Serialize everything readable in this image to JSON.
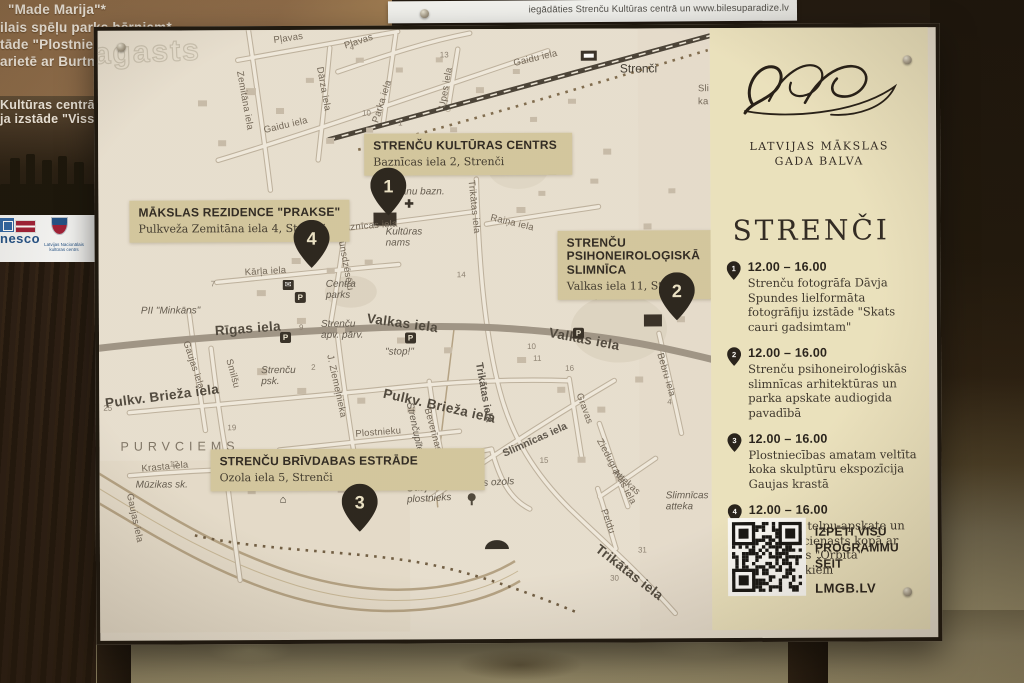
{
  "surroundings": {
    "ticket_strip_text": "iegādāties Strenču Kultūras centrā un www.bilesuparadize.lv",
    "back_sign": {
      "lines": [
        "\"Made Marija\"*",
        "ilais spēļu parks bērniem*",
        "tāde \"Plostnieku",
        "arietē ar Burtnie"
      ],
      "photo_lines": [
        "Kultūras centrā a",
        "ja izstāde \"Viss, k"
      ],
      "unesco_text": "nesco",
      "lnkc_text": "Latvijas Nacionālais kultūras centrs"
    }
  },
  "board": {
    "logo": {
      "line1": "LATVIJAS MĀKSLAS",
      "line2": "GADA BALVA"
    },
    "panel": {
      "city_title": "STRENČI",
      "schedule": [
        {
          "num": "1",
          "time": "12.00 – 16.00",
          "desc": "Strenču fotogrāfa Dāvja Spundes lielformāta fotogrāfiju izstāde \"Skats cauri gadsimtam\""
        },
        {
          "num": "2",
          "time": "12.00 – 16.00",
          "desc": "Strenču psihoneiroloģiskās slimnīcas arhitektūras un parka apskate audiogida pavadībā"
        },
        {
          "num": "3",
          "time": "12.00 – 16.00",
          "desc": "Plostniecības amatam veltīta koka skulptūru ekspozīcija Gaujas krastā"
        },
        {
          "num": "4",
          "time": "12.00 – 16.00",
          "desc": "Tikšanās, telpu apskate un pankūku cienasts kopā ar apvienības \"Orbīta\" māksliniekiem"
        }
      ],
      "qr_caption_line1": "IZPĒTI VISU",
      "qr_caption_line2": "PROGRAMMU ŠEIT",
      "site": "LMGB.LV"
    },
    "callouts": [
      {
        "num": "1",
        "title": "STRENČU KULTŪRAS CENTRS",
        "address": "Baznīcas iela 2, Strenči"
      },
      {
        "num": "2",
        "title": "STRENČU PSIHONEIROLOĢISKĀ SLIMNĪCA",
        "address": "Valkas iela 11, Strenči"
      },
      {
        "num": "3",
        "title": "STRENČU BRĪVDABAS ESTRĀDE",
        "address": "Ozola iela 5, Strenči"
      },
      {
        "num": "4",
        "title": "MĀKSLAS REZIDENCE \"PRAKSE\"",
        "address": "Pulkveža Zemitāna iela 4, Strenči"
      }
    ],
    "map": {
      "watermark": "agasts",
      "labels": [
        {
          "t": "agasts",
          "x": -4,
          "y": 8,
          "r": -2,
          "c": "wm"
        },
        {
          "t": "Zemitāna iela",
          "x": 141,
          "y": 36,
          "r": 80,
          "c": "s"
        },
        {
          "t": "Pļavas",
          "x": 176,
          "y": 6,
          "r": -8,
          "c": "s"
        },
        {
          "t": "Pļavas",
          "x": 247,
          "y": 12,
          "r": -18,
          "c": "s"
        },
        {
          "t": "Parka iela",
          "x": 278,
          "y": 88,
          "r": -72,
          "c": "s"
        },
        {
          "t": "Dārza iela",
          "x": 221,
          "y": 32,
          "r": 80,
          "c": "s"
        },
        {
          "t": "Gaidu iela",
          "x": 166,
          "y": 96,
          "r": -13,
          "c": "s"
        },
        {
          "t": "Gaidu iela",
          "x": 416,
          "y": 30,
          "r": -13,
          "c": "s"
        },
        {
          "t": "Upes iela",
          "x": 345,
          "y": 74,
          "r": -80,
          "c": "s"
        },
        {
          "t": "Strenči",
          "x": 522,
          "y": 34,
          "r": 0,
          "c": "st"
        },
        {
          "t": "Sli",
          "x": 600,
          "y": 56,
          "r": 0,
          "c": "s"
        },
        {
          "t": "ka",
          "x": 600,
          "y": 69,
          "r": 0,
          "c": "s"
        },
        {
          "t": "Raiņa iela",
          "x": 392,
          "y": 184,
          "r": 14,
          "c": "s"
        },
        {
          "t": "Baznīcas iela",
          "x": 240,
          "y": 194,
          "r": -4,
          "c": "s"
        },
        {
          "t": "Trikātas iela",
          "x": 372,
          "y": 146,
          "r": 84,
          "c": "s"
        },
        {
          "t": "rānu bazn.",
          "x": 299,
          "y": 158,
          "r": 0,
          "c": "i"
        },
        {
          "t": "✚",
          "x": 306,
          "y": 170,
          "r": 0,
          "c": "ic",
          "n": "church-icon"
        },
        {
          "t": "Kultūras\nnams",
          "x": 287,
          "y": 198,
          "r": 0,
          "c": "i"
        },
        {
          "t": "14",
          "x": 358,
          "y": 242,
          "c": "n"
        },
        {
          "t": "Ugunsdzēsēju",
          "x": 240,
          "y": 194,
          "r": 80,
          "c": "s"
        },
        {
          "t": "Kārļa iela",
          "x": 146,
          "y": 238,
          "r": -3,
          "c": "s"
        },
        {
          "t": "Centra\nparks",
          "x": 227,
          "y": 250,
          "r": 0,
          "c": "i"
        },
        {
          "t": "✉",
          "x": 184,
          "y": 250,
          "r": 0,
          "c": "icd",
          "n": "post-office-icon"
        },
        {
          "t": "P",
          "x": 196,
          "y": 262,
          "c": "p"
        },
        {
          "t": "PII \"Minkāns\"",
          "x": 42,
          "y": 276,
          "r": 0,
          "c": "i"
        },
        {
          "t": "Rīgas iela",
          "x": 116,
          "y": 294,
          "r": -4,
          "c": "b"
        },
        {
          "t": "Valkas iela",
          "x": 268,
          "y": 282,
          "r": 8,
          "c": "b"
        },
        {
          "t": "Valkas iela",
          "x": 450,
          "y": 297,
          "r": 11,
          "c": "b"
        },
        {
          "t": "Strenču\napv. pārv.",
          "x": 222,
          "y": 290,
          "r": 0,
          "c": "i"
        },
        {
          "t": "\"stop!\"",
          "x": 286,
          "y": 318,
          "r": 0,
          "c": "i"
        },
        {
          "t": "P",
          "x": 181,
          "y": 302,
          "c": "p"
        },
        {
          "t": "P",
          "x": 306,
          "y": 303,
          "c": "p"
        },
        {
          "t": "P",
          "x": 474,
          "y": 299,
          "c": "p"
        },
        {
          "t": "parks",
          "x": 497,
          "y": 262,
          "r": 0,
          "c": "i"
        },
        {
          "t": "Smilšu",
          "x": 129,
          "y": 324,
          "r": 75,
          "c": "s"
        },
        {
          "t": "Strenču\npsk.",
          "x": 162,
          "y": 336,
          "r": 0,
          "c": "i"
        },
        {
          "t": "Gaujas iela",
          "x": 86,
          "y": 306,
          "r": 72,
          "c": "s"
        },
        {
          "t": "J. Ziemeļnieka",
          "x": 230,
          "y": 320,
          "r": 78,
          "c": "s"
        },
        {
          "t": "Pulkv. Brieža iela",
          "x": 284,
          "y": 357,
          "r": 13,
          "c": "b"
        },
        {
          "t": "Pulkv. Brieža iela",
          "x": 6,
          "y": 366,
          "r": -7,
          "c": "b"
        },
        {
          "t": "Beverīnas",
          "x": 327,
          "y": 374,
          "r": 75,
          "c": "s"
        },
        {
          "t": "Strenčupīte",
          "x": 309,
          "y": 368,
          "r": 78,
          "c": "i"
        },
        {
          "t": "Plostnieku",
          "x": 256,
          "y": 400,
          "r": -4,
          "c": "s"
        },
        {
          "t": "Trikātas iela",
          "x": 379,
          "y": 328,
          "r": 80,
          "c": "m"
        },
        {
          "t": "Slimnīcas iela",
          "x": 404,
          "y": 420,
          "r": -24,
          "c": "m"
        },
        {
          "t": "Gravas",
          "x": 479,
          "y": 360,
          "r": 70,
          "c": "s"
        },
        {
          "t": "Ziedugravas iela",
          "x": 499,
          "y": 406,
          "r": 62,
          "c": "s"
        },
        {
          "t": "Attekas",
          "x": 514,
          "y": 438,
          "r": 42,
          "c": "s"
        },
        {
          "t": "Peldu",
          "x": 503,
          "y": 476,
          "r": 70,
          "c": "s"
        },
        {
          "t": "Bebru iela",
          "x": 560,
          "y": 320,
          "r": 74,
          "c": "s"
        },
        {
          "t": "Ozola",
          "x": 352,
          "y": 427,
          "r": -14,
          "c": "s"
        },
        {
          "t": "Vecais ozols",
          "x": 359,
          "y": 451,
          "r": -3,
          "c": "i"
        },
        {
          "t": "Gaujas\nplostnieks",
          "x": 307,
          "y": 455,
          "r": -3,
          "c": "i"
        },
        {
          "t": "P",
          "x": 320,
          "y": 438,
          "c": "p"
        },
        {
          "t": "⌂",
          "x": 180,
          "y": 465,
          "r": 0,
          "c": "ic",
          "n": "house-icon"
        },
        {
          "t": "Slimnīcas\natteka",
          "x": 566,
          "y": 463,
          "r": 0,
          "c": "i"
        },
        {
          "t": "Trikātas iela",
          "x": 497,
          "y": 512,
          "r": 38,
          "c": "b"
        },
        {
          "t": "PURVCIEMS",
          "x": 21,
          "y": 410,
          "r": 0,
          "c": "cap"
        },
        {
          "t": "Krasta iela",
          "x": 42,
          "y": 434,
          "r": -5,
          "c": "s"
        },
        {
          "t": "Mūzikas sk.",
          "x": 36,
          "y": 450,
          "r": 0,
          "c": "i"
        },
        {
          "t": "Gaujas iela",
          "x": 29,
          "y": 458,
          "r": 78,
          "c": "s"
        },
        {
          "t": "13",
          "x": 342,
          "y": 22,
          "c": "n"
        },
        {
          "t": "4",
          "x": 252,
          "y": 14,
          "c": "n"
        },
        {
          "t": "10",
          "x": 264,
          "y": 80,
          "c": "n"
        },
        {
          "t": "1",
          "x": 300,
          "y": 90,
          "c": "n"
        },
        {
          "t": "7",
          "x": 112,
          "y": 250,
          "c": "n"
        },
        {
          "t": "9",
          "x": 200,
          "y": 294,
          "c": "n"
        },
        {
          "t": "2",
          "x": 212,
          "y": 334,
          "c": "n"
        },
        {
          "t": "10",
          "x": 428,
          "y": 314,
          "c": "n"
        },
        {
          "t": "11",
          "x": 434,
          "y": 326,
          "c": "n"
        },
        {
          "t": "16",
          "x": 466,
          "y": 336,
          "c": "n"
        },
        {
          "t": "15",
          "x": 440,
          "y": 428,
          "c": "n"
        },
        {
          "t": "30",
          "x": 510,
          "y": 546,
          "c": "n"
        },
        {
          "t": "31",
          "x": 538,
          "y": 518,
          "c": "n"
        },
        {
          "t": "19",
          "x": 128,
          "y": 394,
          "c": "n"
        },
        {
          "t": "25",
          "x": 4,
          "y": 374,
          "c": "n"
        },
        {
          "t": "12",
          "x": 70,
          "y": 430,
          "c": "n"
        },
        {
          "t": "4",
          "x": 568,
          "y": 370,
          "c": "n"
        },
        {
          "t": "6",
          "x": 294,
          "y": 420,
          "c": "n"
        }
      ]
    }
  }
}
